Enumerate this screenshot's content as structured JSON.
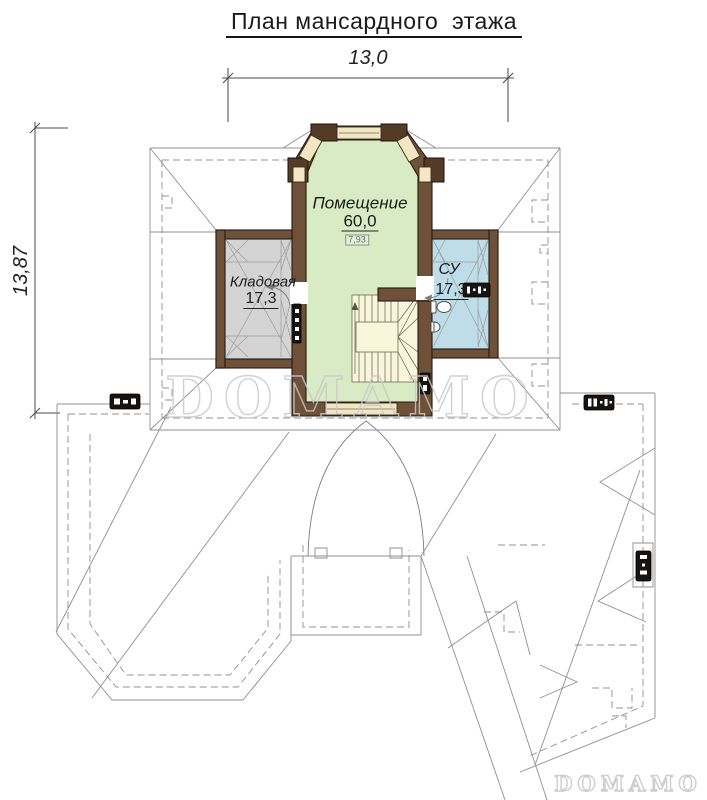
{
  "title": "План мансардного  этажа",
  "dimensions": {
    "width_label": "13,0",
    "height_label": "13,87"
  },
  "rooms": {
    "main": {
      "name": "Помещение",
      "area": "60,0",
      "elevation_mark": "7,93"
    },
    "storage": {
      "name": "Кладовая",
      "area": "17,3"
    },
    "bathroom": {
      "name": "СУ",
      "area": "17,3"
    }
  },
  "watermark": {
    "main": "DOMAMO",
    "footer": "DOMAMO"
  },
  "colors": {
    "wall": "#6e5138",
    "wall_dark": "#543b27",
    "room_main": "#d9ebc5",
    "room_storage": "#d4d4d4",
    "room_bathroom": "#bedde9",
    "window": "#f3e6c5",
    "stairs": "#faf6dc",
    "roof_line": "#909090",
    "dimension": "#4a4a4a",
    "watermark": "#c9c9c9"
  }
}
